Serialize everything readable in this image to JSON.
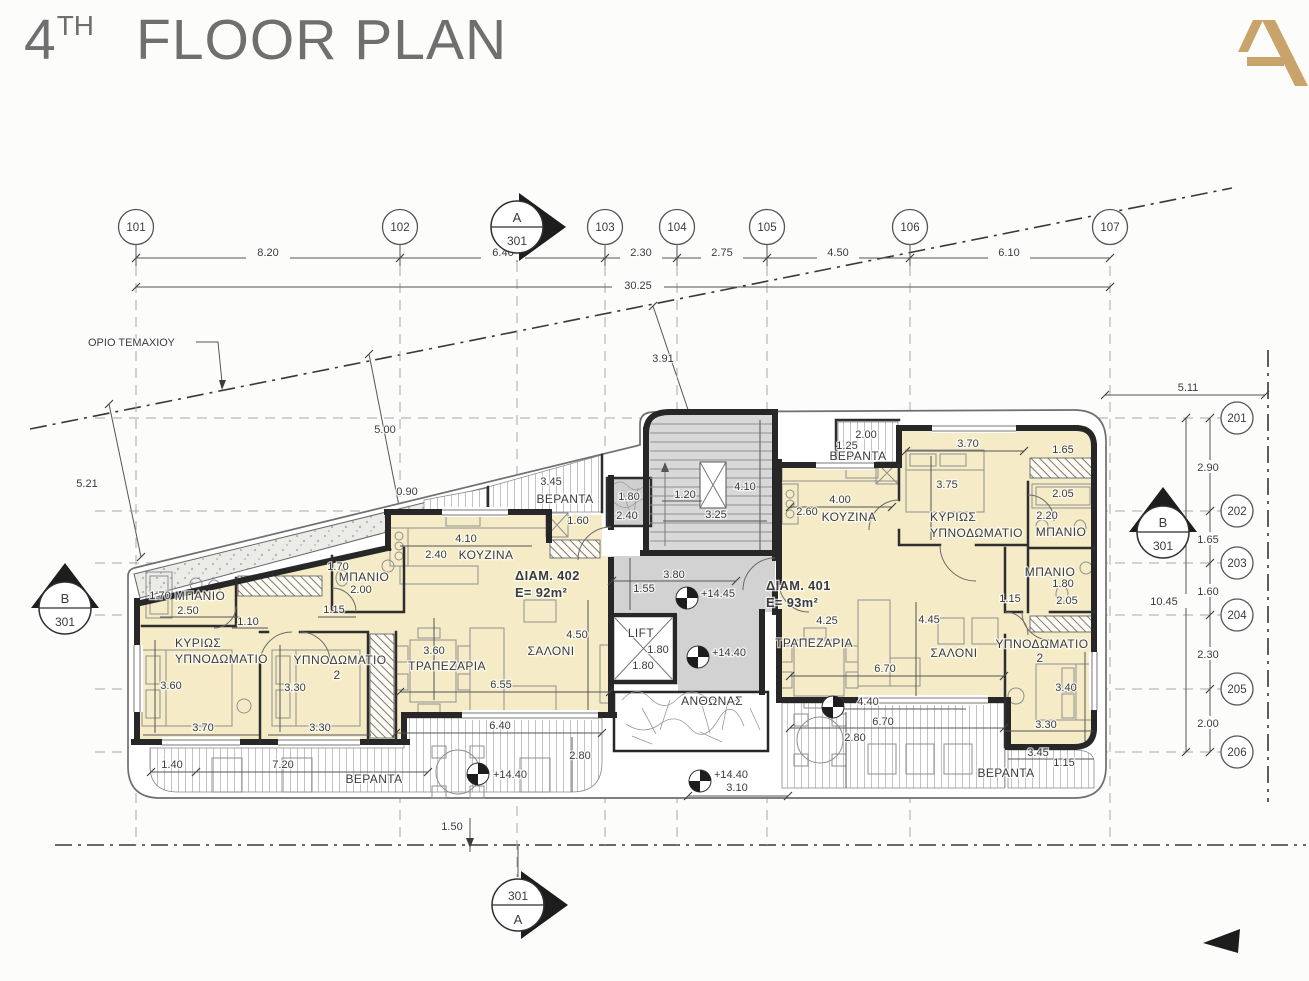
{
  "title": {
    "number": "4",
    "suffix": "TH",
    "text": "FLOOR PLAN"
  },
  "logo": {
    "letter": "A",
    "color": "#c9a46a"
  },
  "site": {
    "boundary_label": "ΟΡΙΟ ΤΕΜΑΧΙΟΥ",
    "dim_left": "5.21",
    "dim_mid": "5.00",
    "dim_stair": "3.91",
    "dim_bottom": "1.50",
    "dim_right_top": "5.11"
  },
  "grid_top": {
    "bubbles": [
      "101",
      "102",
      "103",
      "104",
      "105",
      "106",
      "107"
    ],
    "dims": [
      "8.20",
      "6.40",
      "2.30",
      "2.75",
      "4.50",
      "6.10"
    ],
    "total": "30.25"
  },
  "grid_right": {
    "bubbles": [
      "201",
      "202",
      "203",
      "204",
      "205",
      "206"
    ],
    "dims": [
      "2.90",
      "1.65",
      "1.60",
      "2.30",
      "2.00"
    ],
    "total": "10.45"
  },
  "sections": {
    "top": {
      "letter": "A",
      "sheet": "301"
    },
    "bottom": {
      "sheet": "301",
      "letter": "A"
    },
    "left": {
      "letter": "B",
      "sheet": "301"
    },
    "right": {
      "letter": "B",
      "sheet": "301"
    }
  },
  "core": {
    "shaft_dims": [
      "1.80",
      "2.40"
    ],
    "stair_dims": [
      "1.20",
      "4.10",
      "3.25"
    ],
    "landing": {
      "dims": [
        "3.80",
        "1.55"
      ],
      "level": "+14.45"
    },
    "lift": {
      "label": "LIFT",
      "dims": [
        "1.80",
        "1.80"
      ]
    },
    "mid_level": "+14.40",
    "planter_label": "ΑΝΘΩΝΑΣ",
    "bottom_level": "+14.40",
    "bottom_dim": "3.10"
  },
  "apt402": {
    "name": "ΔΙΑΜ. 402",
    "area": "E=  92m²",
    "bath1": {
      "label": "ΜΠΑΝΙΟ",
      "dims": [
        "1.70",
        "2.50"
      ]
    },
    "hall_dims": [
      "1.10",
      "1.15"
    ],
    "bath2": {
      "label": "ΜΠΑΝΙΟ",
      "dims": [
        "1.70",
        "2.00"
      ]
    },
    "kitchen": {
      "label": "ΚΟΥΖΙΝΑ",
      "dims": [
        "4.10",
        "2.40"
      ]
    },
    "veranda_top": {
      "label": "ΒΕΡΑΝΤΑ",
      "dims": [
        "3.45",
        "0.90",
        "1.60"
      ]
    },
    "bedroom_main": {
      "label1": "ΚΥΡΙΩΣ",
      "label2": "ΥΠΝΟΔΩΜΑΤΙΟ",
      "dims": [
        "3.60",
        "3.70"
      ]
    },
    "bedroom2": {
      "label1": "ΥΠΝΟΔΩΜΑΤΙΟ",
      "label2": "2",
      "dims": [
        "3.30",
        "3.30"
      ]
    },
    "dining": {
      "label": "ΤΡΑΠΕΖΑΡΙΑ",
      "dims": [
        "3.60",
        "6.55"
      ]
    },
    "salon": {
      "label": "ΣΑΛΟΝΙ",
      "dims": [
        "4.50"
      ]
    },
    "veranda_bottom": {
      "label": "ΒΕΡΑΝΤΑ",
      "dims": [
        "1.40",
        "7.20",
        "6.40",
        "2.80"
      ],
      "level": "+14.40"
    }
  },
  "apt401": {
    "name": "ΔΙΑΜ. 401",
    "area": "E=  93m²",
    "kitchen": {
      "label": "ΚΟΥΖΙΝΑ",
      "dims": [
        "4.00",
        "2.60"
      ]
    },
    "veranda_top": {
      "label": "ΒΕΡΑΝΤΑ",
      "dims": [
        "2.00",
        "1.25"
      ]
    },
    "bedroom_main": {
      "label1": "ΚΥΡΙΩΣ",
      "label2": "ΥΠΝΟΔΩΜΑΤΙΟ",
      "dims": [
        "3.70",
        "3.75",
        "1.65"
      ]
    },
    "bath1": {
      "label": "ΜΠΑΝΙΟ",
      "dims": [
        "2.05",
        "2.20"
      ]
    },
    "bath2": {
      "label": "ΜΠΑΝΙΟ",
      "dims": [
        "1.80",
        "2.05"
      ]
    },
    "hall_dims": [
      "1.15"
    ],
    "dining": {
      "label": "ΤΡΑΠΕΖΑΡΙΑ",
      "dims": [
        "4.25"
      ]
    },
    "salon": {
      "label": "ΣΑΛΟΝΙ",
      "dims": [
        "4.45",
        "6.70"
      ]
    },
    "bedroom2": {
      "label1": "ΥΠΝΟΔΩΜΑΤΙΟ",
      "label2": "2",
      "dims": [
        "3.40",
        "3.30"
      ]
    },
    "veranda_bottom": {
      "label": "ΒΕΡΑΝΤΑ",
      "dims": [
        "4.40",
        "6.70",
        "2.80",
        "3.45",
        "1.15"
      ]
    }
  },
  "colors": {
    "room_fill": "#f5ecc7",
    "core_fill": "#d2d2d2",
    "wall": "#272727",
    "accent": "#c9a46a"
  }
}
